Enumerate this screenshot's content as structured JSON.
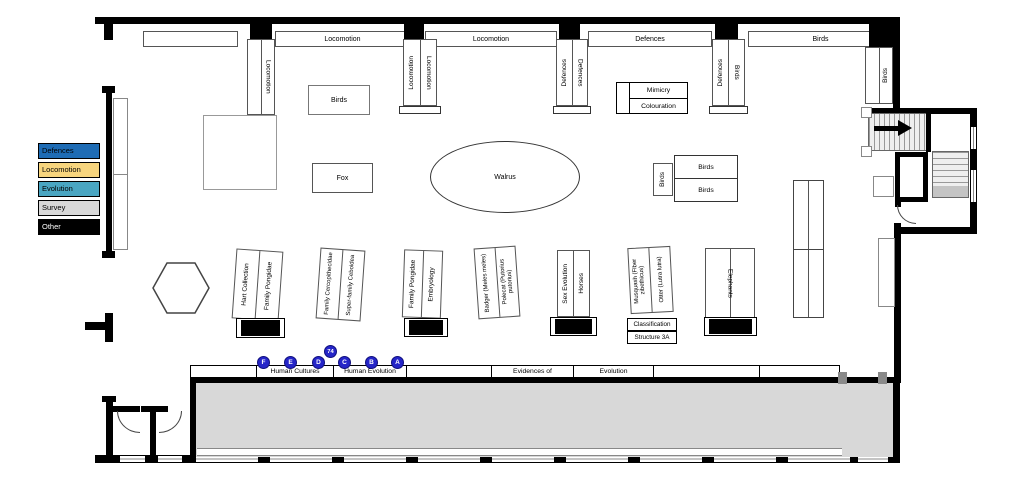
{
  "legend": {
    "items": [
      {
        "label": "Defences",
        "color": "#1e6cb5"
      },
      {
        "label": "Locomotion",
        "color": "#f7d57e"
      },
      {
        "label": "Evolution",
        "color": "#4aa6c2"
      },
      {
        "label": "Survey",
        "color": "#d8d8d8"
      },
      {
        "label": "Other",
        "color": "#000000"
      }
    ]
  },
  "wall_cases": {
    "top_2": "Locomotion",
    "top_3": "Locomotion",
    "top_4": "Defences",
    "top_5": "Birds",
    "pillar_1": "Locomotion",
    "pillar_2_left": "Locomotion",
    "pillar_2_right": "Locomotion",
    "pillar_3_left": "Defences",
    "pillar_3_right": "Defences",
    "pillar_4_left": "Defences",
    "pillar_4_right": "Birds",
    "right_wall": "Birds"
  },
  "floor_cases": {
    "birds_nw": "Birds",
    "fox": "Fox",
    "walrus": "Walrus",
    "mimicry": "Mimicry",
    "colouration": "Colouration",
    "birds_side": "Birds",
    "birds_row_top": "Birds",
    "birds_row_bottom": "Birds",
    "elephants": "Elephants"
  },
  "center_cases": [
    {
      "left": "Hart Collection",
      "right": "Family Pongidae"
    },
    {
      "left": "Family Cercopithecidae",
      "right": "Super-family Ceboidea"
    },
    {
      "left": "Family Pongidae",
      "right": "Embryology"
    },
    {
      "left": "Badger (Meles meles)",
      "right": "Polecat (Putorius putorius)"
    },
    {
      "left": "Sex Evolution",
      "right": "Horses"
    },
    {
      "left": "Musquash (Fiber zibethicus)",
      "right": "Otter (Lutra lutra)"
    }
  ],
  "classification": {
    "line1": "Classification",
    "line2": "Structure 3A"
  },
  "bottom_bar": {
    "segments": [
      "",
      "Human Cultures",
      "Human Evolution",
      "",
      "Evidences of",
      "Evolution",
      "",
      ""
    ]
  },
  "markers": {
    "f": "F",
    "e": "E",
    "d": "D",
    "stop_74": "74",
    "c": "C",
    "b": "B",
    "a": "A"
  }
}
